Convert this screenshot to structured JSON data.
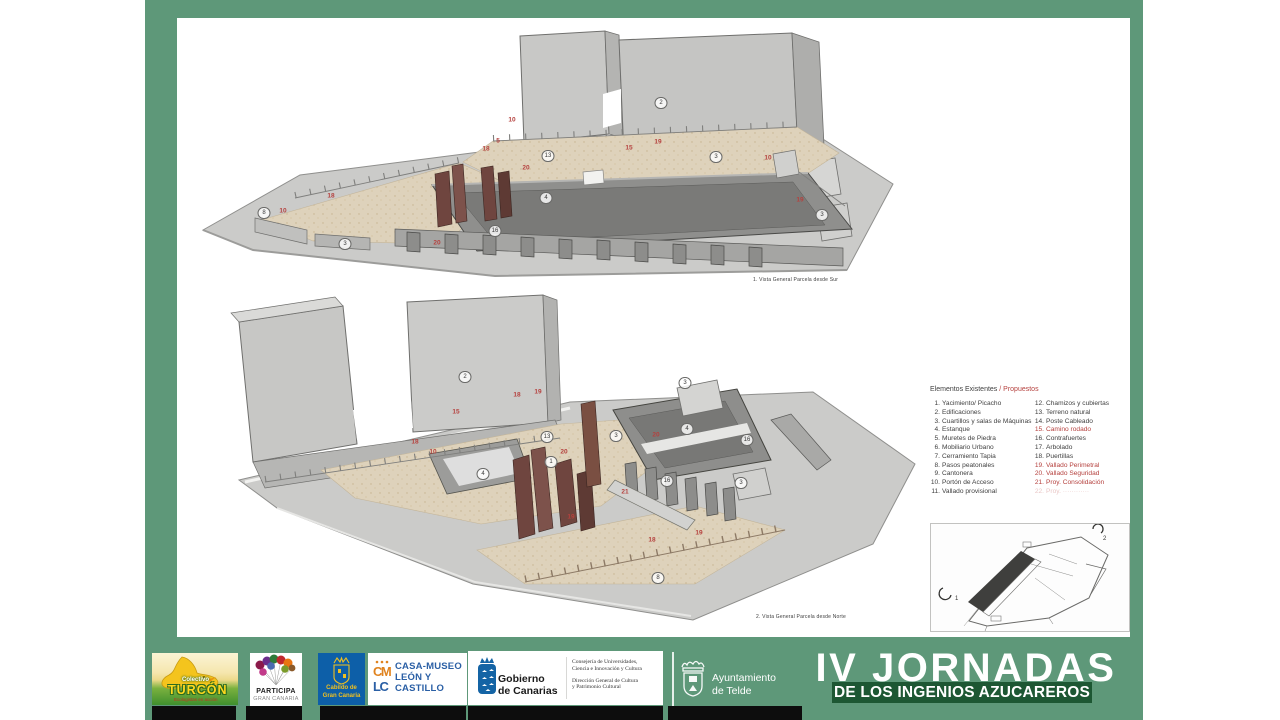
{
  "colors": {
    "frame_green": "#5E9879",
    "band_dark_green": "#1D5733",
    "proposed_red": "#B5413E",
    "cabildo_blue": "#0d5fa8",
    "gobierno_blue": "#1464a5",
    "casamuseo_orange": "#e0831f",
    "casamuseo_blue": "#2a5fa5"
  },
  "views": [
    {
      "caption": "1. Vista General Parcela desde Sur",
      "labels": [
        {
          "n": "2",
          "t": "c",
          "x": 466,
          "y": 81
        },
        {
          "n": "3",
          "t": "c",
          "x": 521,
          "y": 135
        },
        {
          "n": "13",
          "t": "c",
          "x": 353,
          "y": 134
        },
        {
          "n": "4",
          "t": "c",
          "x": 351,
          "y": 176
        },
        {
          "n": "16",
          "t": "c",
          "x": 300,
          "y": 209
        },
        {
          "n": "8",
          "t": "c",
          "x": 69,
          "y": 191
        },
        {
          "n": "3",
          "t": "c",
          "x": 150,
          "y": 222
        },
        {
          "n": "3",
          "t": "c",
          "x": 627,
          "y": 193
        },
        {
          "n": "10",
          "t": "r",
          "x": 317,
          "y": 98
        },
        {
          "n": "5",
          "t": "r",
          "x": 303,
          "y": 119
        },
        {
          "n": "18",
          "t": "r",
          "x": 291,
          "y": 127
        },
        {
          "n": "20",
          "t": "r",
          "x": 331,
          "y": 146
        },
        {
          "n": "15",
          "t": "r",
          "x": 434,
          "y": 126
        },
        {
          "n": "19",
          "t": "r",
          "x": 463,
          "y": 120
        },
        {
          "n": "10",
          "t": "r",
          "x": 573,
          "y": 136
        },
        {
          "n": "19",
          "t": "r",
          "x": 605,
          "y": 178
        },
        {
          "n": "10",
          "t": "r",
          "x": 88,
          "y": 189
        },
        {
          "n": "18",
          "t": "r",
          "x": 136,
          "y": 174
        },
        {
          "n": "20",
          "t": "r",
          "x": 242,
          "y": 221
        }
      ]
    },
    {
      "caption": "2. Vista General Parcela desde Norte",
      "labels": [
        {
          "n": "2",
          "t": "c",
          "x": 240,
          "y": 85
        },
        {
          "n": "3",
          "t": "c",
          "x": 460,
          "y": 91
        },
        {
          "n": "3",
          "t": "c",
          "x": 391,
          "y": 144
        },
        {
          "n": "13",
          "t": "c",
          "x": 322,
          "y": 145
        },
        {
          "n": "4",
          "t": "c",
          "x": 462,
          "y": 137
        },
        {
          "n": "16",
          "t": "c",
          "x": 522,
          "y": 148
        },
        {
          "n": "1",
          "t": "c",
          "x": 326,
          "y": 170
        },
        {
          "n": "4",
          "t": "c",
          "x": 258,
          "y": 182
        },
        {
          "n": "16",
          "t": "c",
          "x": 442,
          "y": 189
        },
        {
          "n": "3",
          "t": "c",
          "x": 516,
          "y": 191
        },
        {
          "n": "8",
          "t": "c",
          "x": 433,
          "y": 286
        },
        {
          "n": "19",
          "t": "r",
          "x": 313,
          "y": 100
        },
        {
          "n": "18",
          "t": "r",
          "x": 292,
          "y": 103
        },
        {
          "n": "15",
          "t": "r",
          "x": 231,
          "y": 120
        },
        {
          "n": "18",
          "t": "r",
          "x": 190,
          "y": 150
        },
        {
          "n": "10",
          "t": "r",
          "x": 208,
          "y": 160
        },
        {
          "n": "20",
          "t": "r",
          "x": 339,
          "y": 160
        },
        {
          "n": "20",
          "t": "r",
          "x": 431,
          "y": 143
        },
        {
          "n": "21",
          "t": "r",
          "x": 400,
          "y": 200
        },
        {
          "n": "19",
          "t": "r",
          "x": 346,
          "y": 225
        },
        {
          "n": "18",
          "t": "r",
          "x": 427,
          "y": 248
        },
        {
          "n": "19",
          "t": "r",
          "x": 474,
          "y": 241
        }
      ]
    }
  ],
  "legend": {
    "header_existing": "Elementos Existentes",
    "header_proposed": "/ Propuestos",
    "left": [
      {
        "num": "1.",
        "label": "Yacimiento/ Picacho"
      },
      {
        "num": "2.",
        "label": "Edificaciones"
      },
      {
        "num": "3.",
        "label": "Cuartillos y salas de Máquinas"
      },
      {
        "num": "4.",
        "label": "Estanque"
      },
      {
        "num": "5.",
        "label": "Muretes de Piedra"
      },
      {
        "num": "6.",
        "label": "Mobiliario Urbano"
      },
      {
        "num": "7.",
        "label": "Cerramiento Tapia"
      },
      {
        "num": "8.",
        "label": "Pasos peatonales"
      },
      {
        "num": "9.",
        "label": "Cantonera"
      },
      {
        "num": "10.",
        "label": "Portón de Acceso"
      },
      {
        "num": "11.",
        "label": "Vallado provisional"
      }
    ],
    "right": [
      {
        "num": "12.",
        "label": "Chamizos y cubiertas"
      },
      {
        "num": "13.",
        "label": "Terreno natural"
      },
      {
        "num": "14.",
        "label": "Poste Cableado"
      },
      {
        "num": "15.",
        "label": "Camino rodado",
        "proposed": true
      },
      {
        "num": "16.",
        "label": "Contrafuertes"
      },
      {
        "num": "17.",
        "label": "Arbolado"
      },
      {
        "num": "18.",
        "label": "Puertillas"
      },
      {
        "num": "19.",
        "label": "Vallado Perimetral",
        "proposed": true
      },
      {
        "num": "20.",
        "label": "Vallado Seguridad",
        "proposed": true
      },
      {
        "num": "21.",
        "label": "Proy. Consolidación",
        "proposed": true
      },
      {
        "num": "22.",
        "label": "Proy. ············",
        "proposed": true,
        "faint": true
      }
    ]
  },
  "inset": {
    "view_marker_1": "1",
    "view_marker_2": "2"
  },
  "footer": {
    "turcon": {
      "line1": "Colectivo",
      "line2": "TURCÓN",
      "line3": "Ecologistas en acción"
    },
    "participa": {
      "line1": "PARTICIPA",
      "line2": "GRAN CANARIA"
    },
    "cabildo": {
      "line1": "Cabildo de",
      "line2": "Gran Canaria"
    },
    "casamuseo": {
      "mono_top": "CM",
      "mono_bottom": "LC",
      "line1": "CASA-MUSEO",
      "line2": "LEÓN Y",
      "line3": "CASTILLO"
    },
    "gobierno": {
      "name1": "Gobierno",
      "name2": "de Canarias",
      "dept1": "Consejería de Universidades,",
      "dept2": "Ciencia e Innovación y Cultura",
      "dept3": "Dirección General de Cultura",
      "dept4": "y Patrimonio Cultural"
    },
    "telde": {
      "line1": "Ayuntamiento",
      "line2": "de Telde"
    },
    "title": {
      "line1": "IV JORNADAS",
      "line2": "DE LOS INGENIOS AZUCAREROS"
    }
  }
}
